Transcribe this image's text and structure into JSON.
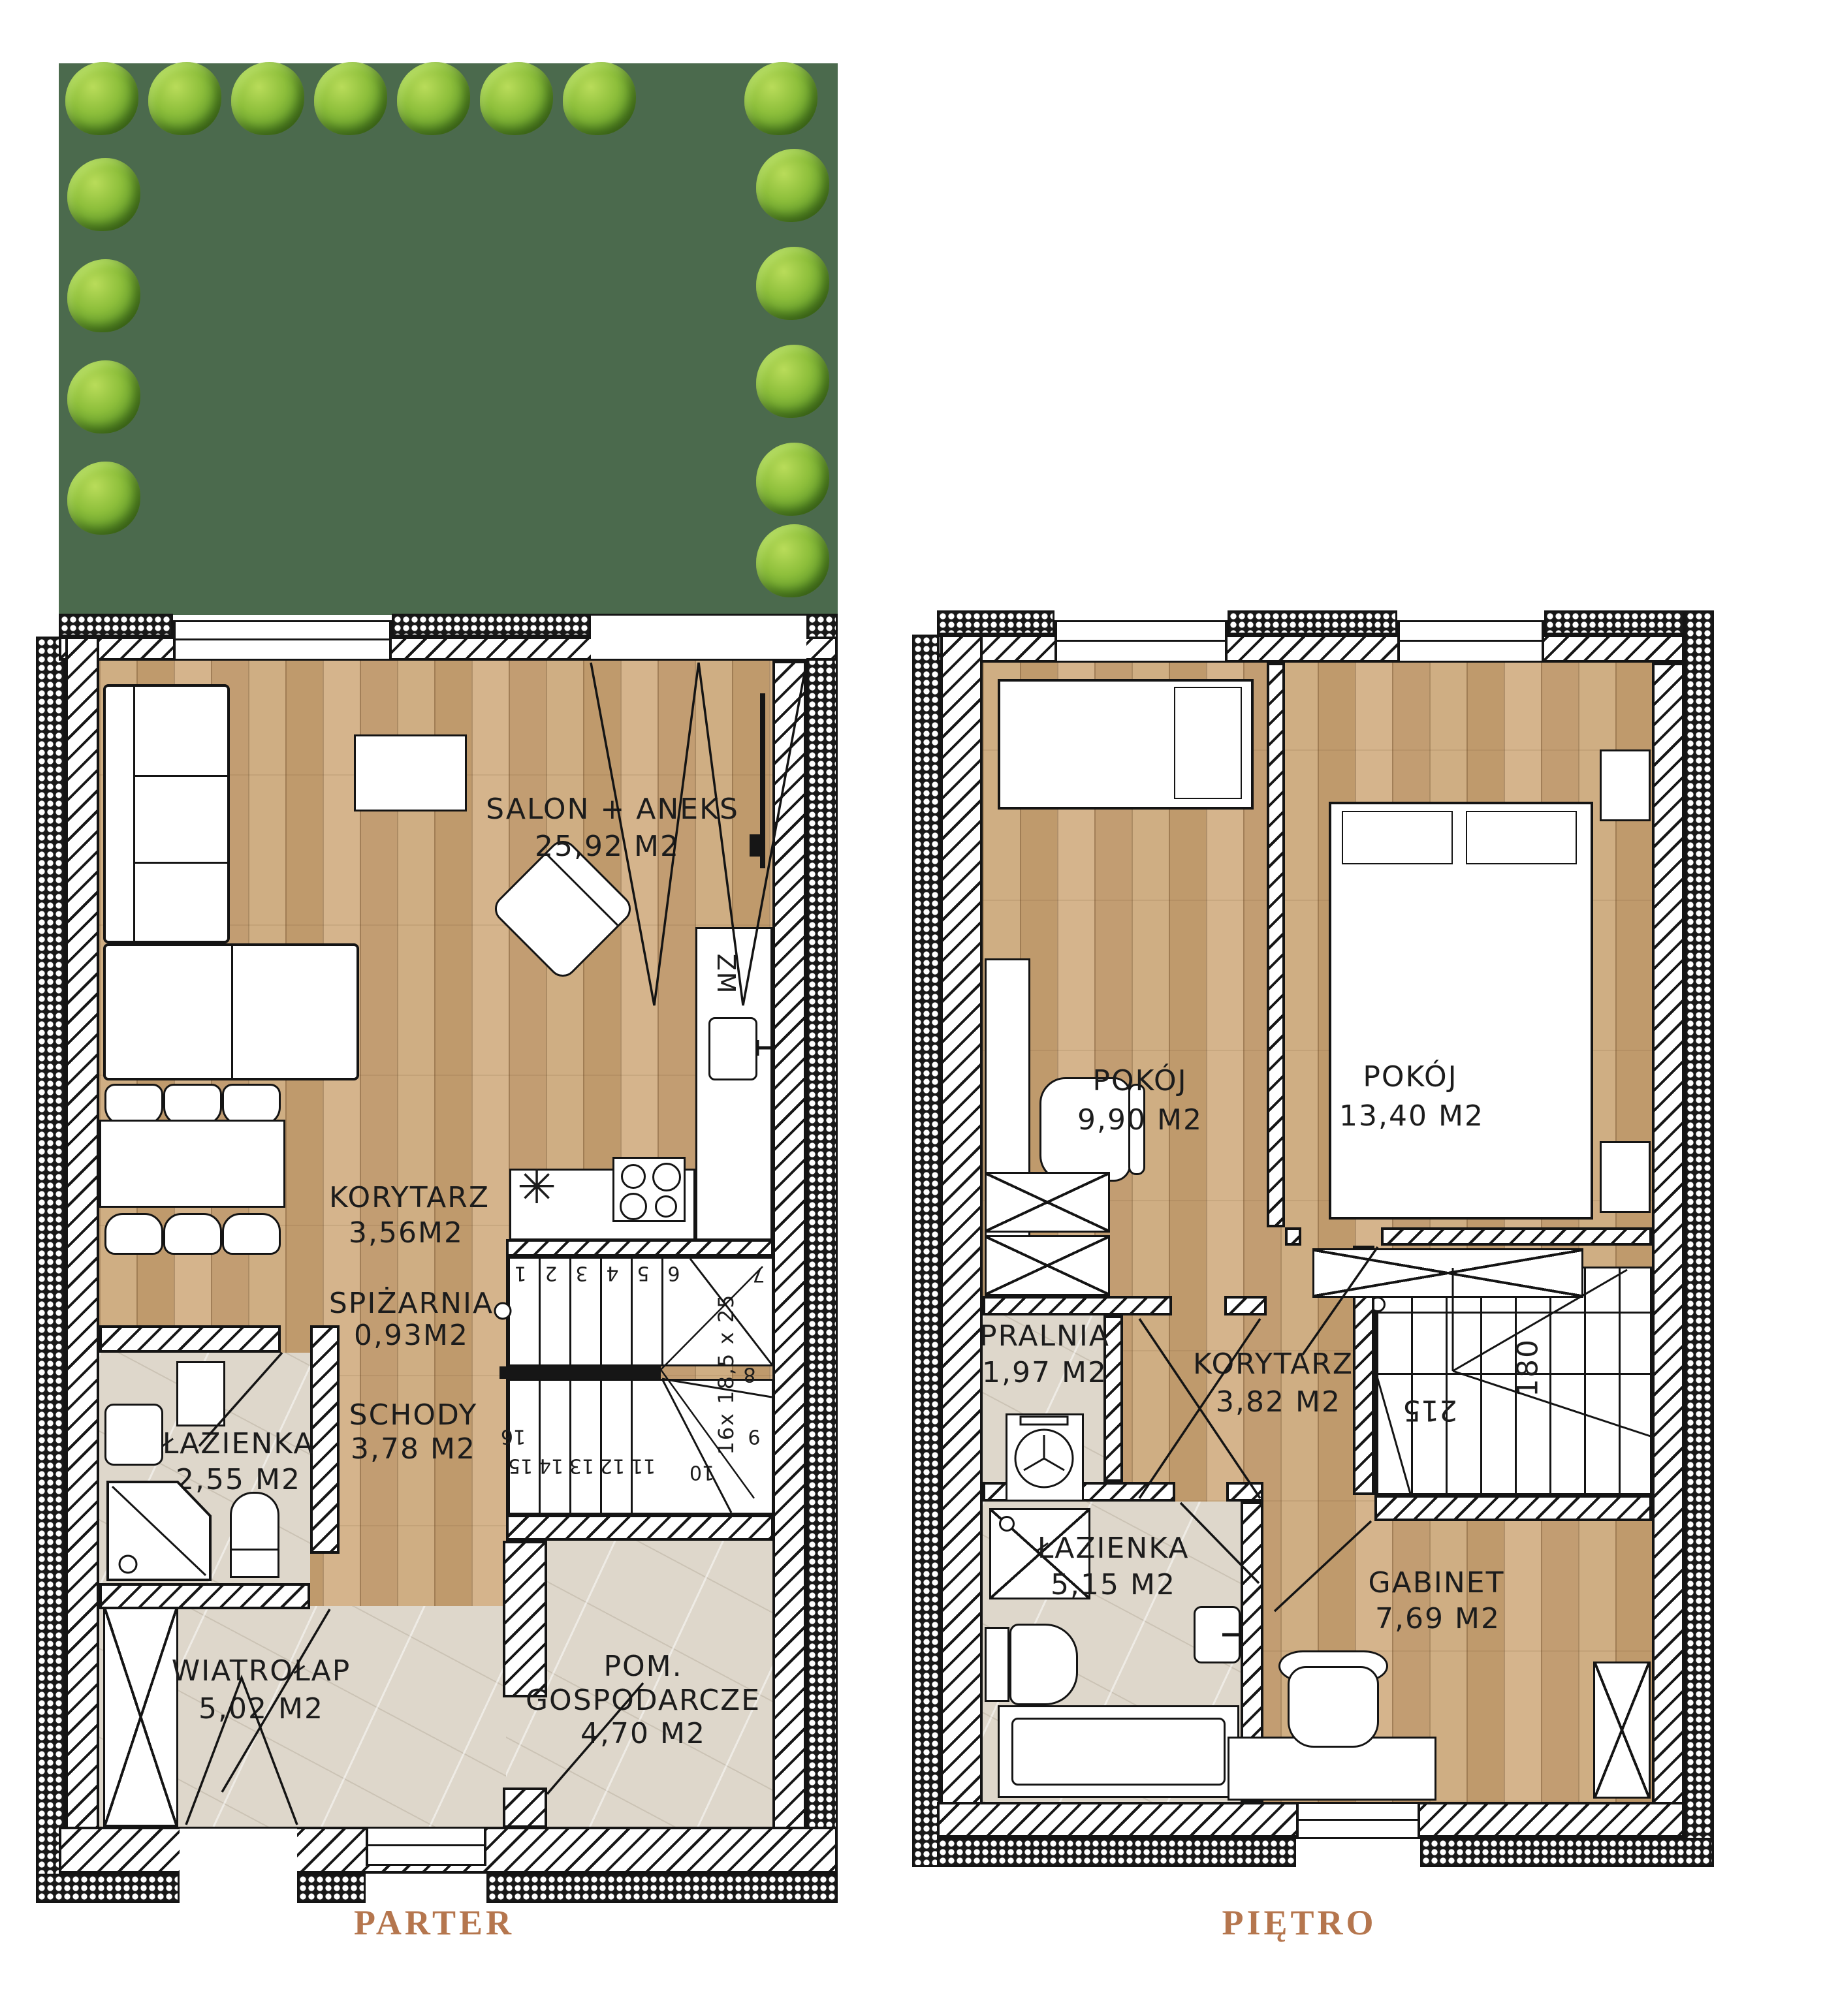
{
  "document": {
    "type": "two-storey house floor plan"
  },
  "colors": {
    "garden_green": "#4b6a4d",
    "bush_green": "#8fc03c",
    "wood_floor": "#c9a77b",
    "tile_floor": "#ded7cb",
    "accent_title": "#b5764e",
    "line": "#141414"
  },
  "parter": {
    "title": "PARTER",
    "salon_name": "SALON + ANEKS",
    "salon_area": "25,92 M2",
    "korytarz_name": "KORYTARZ",
    "korytarz_area": "3,56M2",
    "spizarnia_name": "SPIŻARNIA",
    "spizarnia_area": "0,93M2",
    "schody_name": "SCHODY",
    "schody_area": "3,78 M2",
    "lazienka_name": "ŁAZIENKA",
    "lazienka_area": "2,55 M2",
    "wiatrolap_name": "WIATROŁAP",
    "wiatrolap_area": "5,02 M2",
    "pom_name1": "POM.",
    "pom_name2": "GOSPODARCZE",
    "pom_area": "4,70 M2",
    "sink_label": "ZM",
    "fridge_symbol": "✳",
    "stairs": {
      "dim": "16x 18,5 x 25",
      "steps": [
        "1",
        "2",
        "3",
        "4",
        "5",
        "6",
        "7",
        "8",
        "9",
        "10",
        "11",
        "12",
        "13",
        "14",
        "15",
        "16"
      ]
    }
  },
  "pietro": {
    "title": "PIĘTRO",
    "pokoj1_name": "POKÓJ",
    "pokoj1_area": "9,90 M2",
    "pokoj2_name": "POKÓJ",
    "pokoj2_area": "13,40 M2",
    "pralnia_name": "PRALNIA",
    "pralnia_area": "1,97 M2",
    "korytarz_name": "KORYTARZ",
    "korytarz_area": "3,82 M2",
    "lazienka_name": "ŁAZIENKA",
    "lazienka_area": "5,15 M2",
    "gabinet_name": "GABINET",
    "gabinet_area": "7,69 M2",
    "stairs": {
      "headroom_1": "215",
      "headroom_2": "180"
    }
  }
}
